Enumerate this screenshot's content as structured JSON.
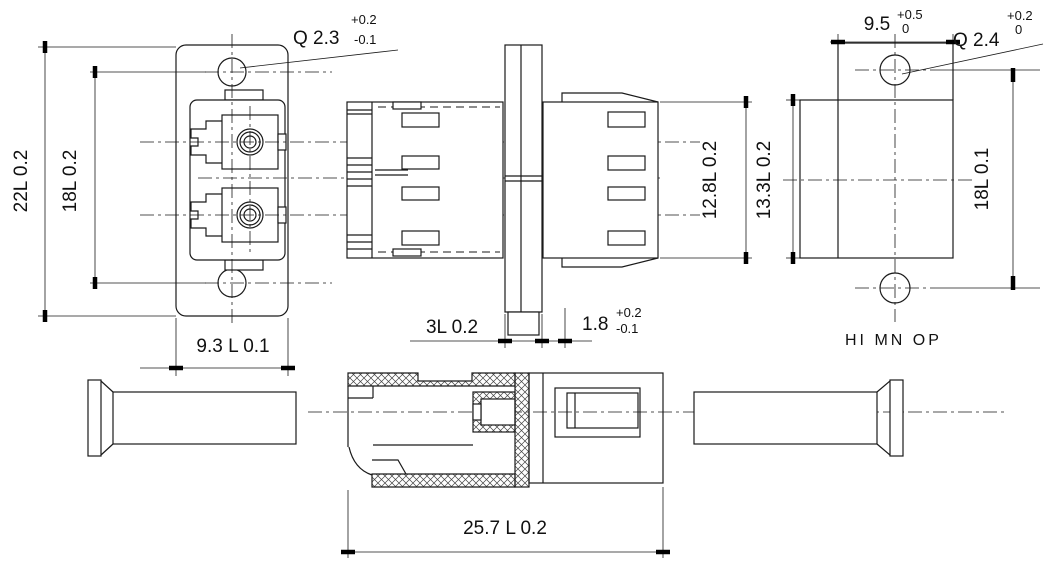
{
  "drawing": {
    "colors": {
      "line": "#1a1a1a",
      "background": "#ffffff"
    },
    "dims": {
      "front_height": "22L 0.2",
      "front_hole_spacing": "18L 0.2",
      "front_width": "9.3 L 0.1",
      "front_hole_dia": {
        "main": "Q 2.3",
        "upper": "+0.2",
        "lower": "-0.1"
      },
      "flange_thickness": "3L 0.2",
      "flange_offset": {
        "main": "1.8",
        "upper": "+0.2",
        "lower": "-0.1"
      },
      "body_height": "12.8L 0.2",
      "rear_body_height": "13.3L 0.2",
      "rear_top_width": {
        "main": "9.5",
        "upper": "+0.5",
        "lower": "0"
      },
      "rear_hole_dia": {
        "main": "Q 2.4",
        "upper": "+0.2",
        "lower": "0"
      },
      "rear_hole_spacing": "18L 0.1",
      "overall_length": "25.7 L 0.2"
    },
    "labels": {
      "rear_note": "HI MN OP"
    }
  }
}
